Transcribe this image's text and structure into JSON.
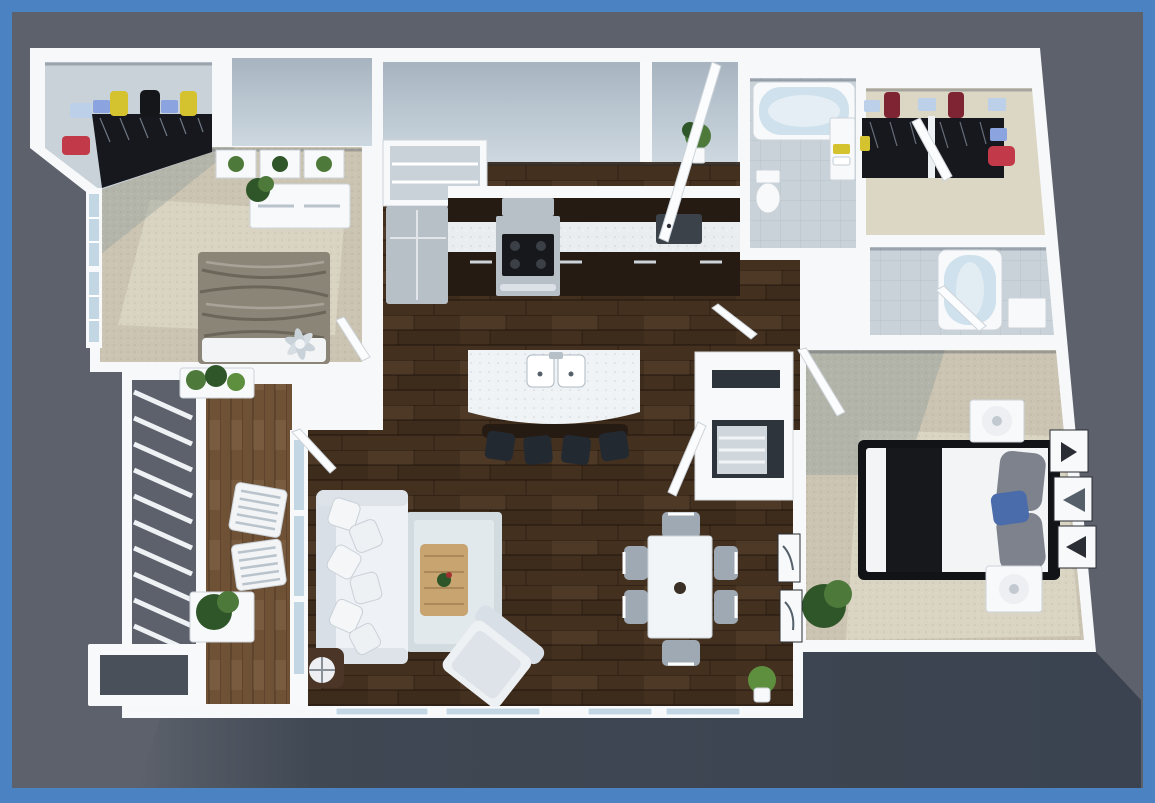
{
  "meta": {
    "type": "3d-floor-plan-render",
    "description": "Top-down 3D architectural render of a two-bedroom, two-bathroom apartment with balcony, framed by a blue border on a gray background"
  },
  "frame": {
    "color": "#4a82c2",
    "thickness_top": 12,
    "thickness_bottom": 15
  },
  "background": {
    "color": "#5c616b",
    "shadow_color": "#3a434f"
  },
  "palette": {
    "wall": "#f6f8fa",
    "wall_face_light": "#c6d1da",
    "wall_face_dark": "#9dabb8",
    "wood_floor": "#44301f",
    "deck_wood": "#6f5136",
    "carpet": "#cbc4b2",
    "carpet_light": "#dcd6c4",
    "carpet_shadow": "#9aa49f",
    "tile": "#c9d2d9",
    "cabinet_dark": "#261b13",
    "counter_marble": "#e9edf0",
    "steel": "#b7bfc7",
    "island_top": "#eff3f5",
    "stool_black": "#232931",
    "sofa_white": "#eef1f5",
    "cushion_shade": "#d9dfe6",
    "rug": "#d2dce0",
    "coffee_table_wood": "#c7a470",
    "armchair_white": "#eef1f4",
    "dining_table_white": "#f2f5f7",
    "dining_chair_gray": "#9fa9b4",
    "bed2_blanket": "#8b8577",
    "bed_sheet_white": "#f2f4f6",
    "bed_black": "#16181c",
    "pillow_gray": "#7d828c",
    "pillow_blue": "#4a6cab",
    "headboard_black": "#111317",
    "tub_blue": "#cfe1ec",
    "fixture_white": "#eef2f5",
    "plant_green": "#4d7a3b",
    "plant_dark_green": "#2f5628",
    "grass_green": "#5d8f3f",
    "box_yellow": "#d4c22f",
    "box_blue": "#8ba4e0",
    "box_light_blue": "#bdd0ea",
    "box_red": "#c23a49",
    "box_crimson": "#7e2433",
    "box_black": "#141619",
    "clothes_dark": "#16181e",
    "lamp_white": "#edeff2",
    "doormat_dark": "#3c4249",
    "door_white": "#fbfcfd",
    "glass_blue": "#c3d6e4",
    "side_table_dark": "#4a3526"
  },
  "rooms": [
    {
      "id": "walk-in-closet-1",
      "name": "Walk-in Closet (Bedroom 2)",
      "floor": "tile",
      "contents": [
        "yellow, blue and black luggage on shelf",
        "hanging clothes",
        "red storage box"
      ]
    },
    {
      "id": "bedroom-2",
      "name": "Bedroom 2",
      "floor": "carpet",
      "contents": [
        "double bed with gray blanket",
        "dresser with potted plant",
        "three botanical wall prints",
        "window",
        "ceiling fan"
      ]
    },
    {
      "id": "kitchen",
      "name": "Kitchen",
      "floor": "hardwood",
      "contents": [
        "refrigerator",
        "range with hood",
        "dark base cabinets with marble counter",
        "pantry closet",
        "island with double sink",
        "four black bar stools"
      ]
    },
    {
      "id": "entry",
      "name": "Entry Hall",
      "floor": "hardwood",
      "contents": [
        "open front door",
        "dark doormat",
        "potted plant"
      ]
    },
    {
      "id": "bathroom-2",
      "name": "Hall Bathroom",
      "floor": "tile",
      "contents": [
        "bathtub",
        "toilet",
        "vanity with yellow towels"
      ]
    },
    {
      "id": "walk-in-closet-2",
      "name": "Walk-in Closet (Master)",
      "floor": "carpet",
      "contents": [
        "crimson and blue boxes on shelf",
        "hanging clothes",
        "red and blue storage boxes"
      ]
    },
    {
      "id": "master-bathroom",
      "name": "Master Bathroom",
      "floor": "tile",
      "contents": [
        "bathtub",
        "vanity cabinet",
        "open door"
      ]
    },
    {
      "id": "laundry-closet",
      "name": "Laundry / Storage Closets",
      "floor": "hardwood",
      "contents": [
        "stacked storage closets with open white doors",
        "shelving unit"
      ]
    },
    {
      "id": "master-bedroom",
      "name": "Master Bedroom",
      "floor": "carpet",
      "contents": [
        "bed with black-and-white bedding and blue accent pillow",
        "two nightstands with white lamps",
        "three framed prints on wall",
        "potted plant"
      ]
    },
    {
      "id": "living-room",
      "name": "Living Room",
      "floor": "hardwood",
      "contents": [
        "white sofa piled with pillows",
        "light area rug",
        "wood coffee table with plant",
        "angled armchair",
        "dark side table with globe lamp"
      ]
    },
    {
      "id": "dining-area",
      "name": "Dining Area",
      "floor": "hardwood",
      "contents": [
        "white dining table with centerpiece",
        "six gray chairs",
        "two framed sketches on wall",
        "floor plant"
      ]
    },
    {
      "id": "balcony",
      "name": "Balcony",
      "floor": "deck",
      "contents": [
        "white slat railing",
        "two white lounge chairs",
        "two planter boxes with plants",
        "storage step box"
      ]
    }
  ]
}
